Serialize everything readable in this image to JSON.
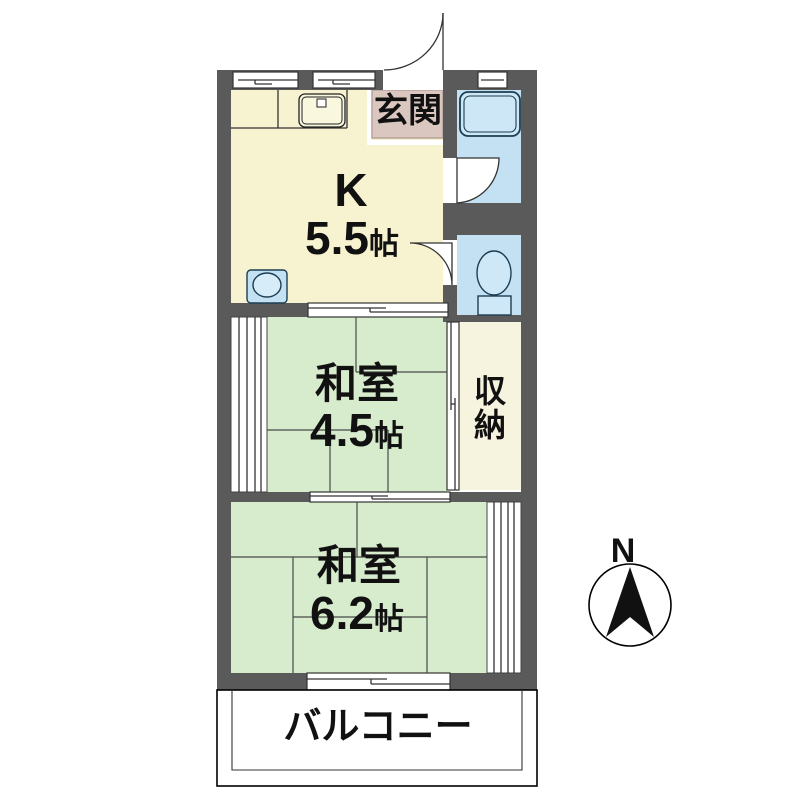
{
  "plan_title": "apartment-floor-plan",
  "rooms": {
    "kitchen": {
      "label": "K",
      "area_value": "5.5",
      "area_unit": "帖"
    },
    "entrance": {
      "label": "玄関"
    },
    "japanese_room_middle": {
      "label": "和室",
      "area_value": "4.5",
      "area_unit": "帖"
    },
    "japanese_room_bottom": {
      "label": "和室",
      "area_value": "6.2",
      "area_unit": "帖"
    },
    "storage": {
      "char_top": "収",
      "char_bottom": "納"
    },
    "balcony": {
      "label": "バルコニー"
    }
  },
  "compass": {
    "north_label": "N"
  },
  "icons": {
    "sink": "kitchen-sink",
    "washer": "washing-machine",
    "bathtub": "bathtub",
    "toilet": "toilet-bowl"
  },
  "colors": {
    "wall": "#5A5A5A",
    "kitchen_floor": "#F7F3D0",
    "tatami_floor": "#D7EBCD",
    "wet_area": "#C3E1F2",
    "entrance_floor": "#D9C7C0",
    "storage_floor": "#F6F3DE",
    "outline": "#333333"
  }
}
